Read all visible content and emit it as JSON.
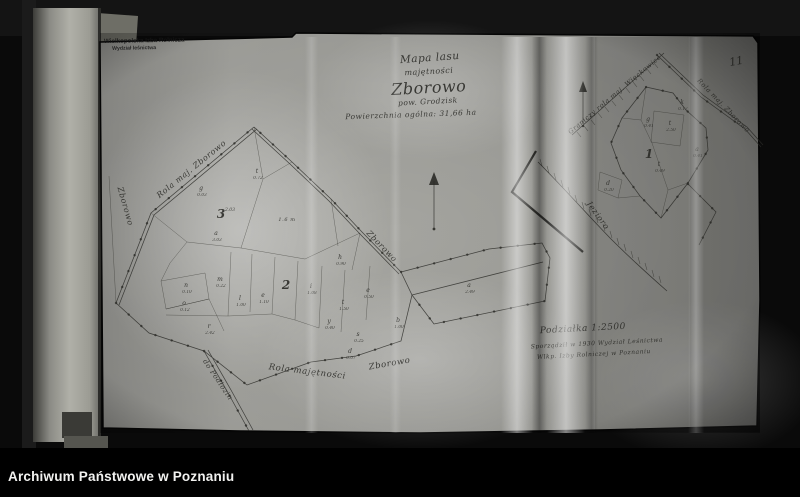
{
  "colors": {
    "ink": "#2b2b27",
    "paper": "#a4a49f",
    "background": "#0a0a0a",
    "caption_bg": "#000000",
    "caption_fg": "#f2f2f0"
  },
  "caption_bar": {
    "text": "Archiwum Państwowe w Poznaniu"
  },
  "page_number": "11",
  "stamp": {
    "line1": "Wielkopolska Izba Rolnicza",
    "line2": "Wydział leśnictwa"
  },
  "title_block": {
    "line1": "Mapa lasu",
    "line2": "majętności",
    "line3": "Zborowo",
    "line4": "pow. Grodzisk",
    "line5": "Powierzchnia ogólna: 31,66 ha"
  },
  "scale_block": {
    "line1": "Podziałka 1:2500",
    "line2": "Sporządził w 1930 Wydział Leśnictwa",
    "line3": "Wlkp. Izby Rolniczej w Poznaniu"
  },
  "road_labels": [
    {
      "text": "Rola maj. Zborowo",
      "x": 193,
      "y": 171,
      "r": -39,
      "s": 8
    },
    {
      "text": "Zborowo",
      "x": 123,
      "y": 207,
      "r": 74,
      "s": 8
    },
    {
      "text": "Zborowo",
      "x": 380,
      "y": 248,
      "r": 46,
      "s": 8
    },
    {
      "text": "Rola majętności",
      "x": 307,
      "y": 374,
      "r": 7,
      "s": 8.5
    },
    {
      "text": "Zborowo",
      "x": 390,
      "y": 366,
      "r": -10,
      "s": 8.5
    },
    {
      "text": "do Podłozin",
      "x": 216,
      "y": 381,
      "r": 56,
      "s": 7
    },
    {
      "text": "Jezioro",
      "x": 596,
      "y": 217,
      "r": 54,
      "s": 8
    },
    {
      "text": "Graniczy rola maj. Więckowice",
      "x": 616,
      "y": 96,
      "r": -40,
      "s": 6.5
    },
    {
      "text": "Rola maj. Zborowo",
      "x": 722,
      "y": 107,
      "r": 46,
      "s": 6.5
    },
    {
      "text": "1.6 m",
      "x": 287,
      "y": 221,
      "r": 0,
      "s": 5
    }
  ],
  "big_numbers": [
    {
      "t": "3",
      "a": "2.03",
      "x": 221,
      "y": 218
    },
    {
      "t": "2",
      "a": "",
      "x": 286,
      "y": 289
    },
    {
      "t": "1",
      "a": "",
      "x": 649,
      "y": 158
    }
  ],
  "parcel_labels": [
    {
      "t": "t",
      "a": "0.72",
      "x": 257,
      "y": 173
    },
    {
      "t": "g",
      "a": "0.03",
      "x": 201,
      "y": 190
    },
    {
      "t": "a",
      "a": "3.03",
      "x": 216,
      "y": 235
    },
    {
      "t": "m",
      "a": "0.22",
      "x": 220,
      "y": 281
    },
    {
      "t": "n",
      "a": "0.10",
      "x": 186,
      "y": 287
    },
    {
      "t": "o",
      "a": "0.12",
      "x": 184,
      "y": 305
    },
    {
      "t": "r",
      "a": "2.42",
      "x": 209,
      "y": 328
    },
    {
      "t": "l",
      "a": "1.00",
      "x": 240,
      "y": 300
    },
    {
      "t": "e",
      "a": "1.10",
      "x": 263,
      "y": 297
    },
    {
      "t": "i",
      "a": "1.08",
      "x": 311,
      "y": 288
    },
    {
      "t": "h",
      "a": "0.90",
      "x": 340,
      "y": 259
    },
    {
      "t": "t",
      "a": "1.50",
      "x": 343,
      "y": 304
    },
    {
      "t": "y",
      "a": "0.40",
      "x": 329,
      "y": 323
    },
    {
      "t": "e",
      "a": "0.50",
      "x": 368,
      "y": 292
    },
    {
      "t": "b",
      "a": "1.00",
      "x": 398,
      "y": 322
    },
    {
      "t": "s",
      "a": "0.25",
      "x": 358,
      "y": 336
    },
    {
      "t": "d",
      "a": "0.07",
      "x": 350,
      "y": 353
    },
    {
      "t": "a",
      "a": "2.49",
      "x": 469,
      "y": 287
    },
    {
      "t": "k",
      "a": "0.17",
      "x": 682,
      "y": 104
    },
    {
      "t": "g",
      "a": "0.41",
      "x": 648,
      "y": 121
    },
    {
      "t": "t",
      "a": "2.50",
      "x": 670,
      "y": 125
    },
    {
      "t": "a",
      "a": "0.41",
      "x": 697,
      "y": 151
    },
    {
      "t": "t",
      "a": "0.49",
      "x": 659,
      "y": 166
    },
    {
      "t": "d",
      "a": "0.20",
      "x": 608,
      "y": 185
    }
  ]
}
